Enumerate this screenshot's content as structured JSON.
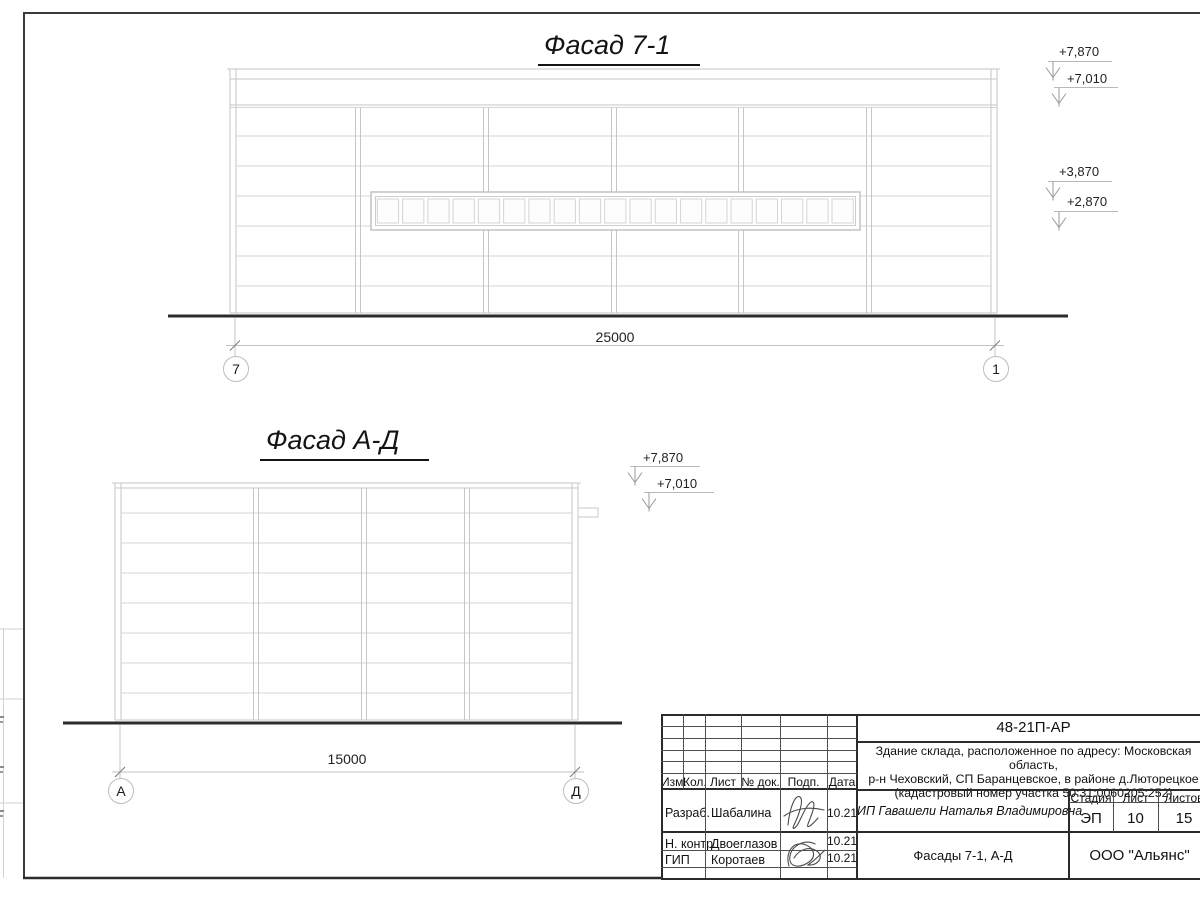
{
  "drawing": {
    "facade_71": {
      "title": "Фасад 7-1",
      "dimension": "25000",
      "axis_left": "7",
      "axis_right": "1",
      "levels": [
        "+7,870",
        "+7,010",
        "+3,870",
        "+2,870"
      ]
    },
    "facade_ad": {
      "title": "Фасад А-Д",
      "dimension": "15000",
      "axis_left": "А",
      "axis_right": "Д",
      "levels": [
        "+7,870",
        "+7,010"
      ]
    }
  },
  "title_block": {
    "doc_code": "48-21П-АР",
    "project_description": "Здание склада, расположенное по адресу: Московская область,\nр-н Чеховский, СП Баранцевское, в районе д.Люторецкое\n(кадастровый номер участка 50:31:0060205:252)",
    "col_izm": "Изм.",
    "col_kol": "Кол.",
    "col_list": "Лист",
    "col_doc": "№ док.",
    "col_podp": "Подп.",
    "col_data": "Дата",
    "rows": [
      {
        "role": "Разраб.",
        "name": "Шабалина",
        "date": "10.21"
      },
      {
        "role": "Н. контр.",
        "name": "Двоеглазов",
        "date": "10.21"
      },
      {
        "role": "ГИП",
        "name": "Коротаев",
        "date": "10.21"
      }
    ],
    "client": "ИП Гавашели Наталья Владимировна",
    "stage_label": "Стадия",
    "sheet_label": "Лист",
    "sheets_label": "Листов",
    "stage": "ЭП",
    "sheet_no": "10",
    "sheets_total": "15",
    "drawing_title": "Фасады 7-1, А-Д",
    "company": "ООО \"Альянс\""
  }
}
